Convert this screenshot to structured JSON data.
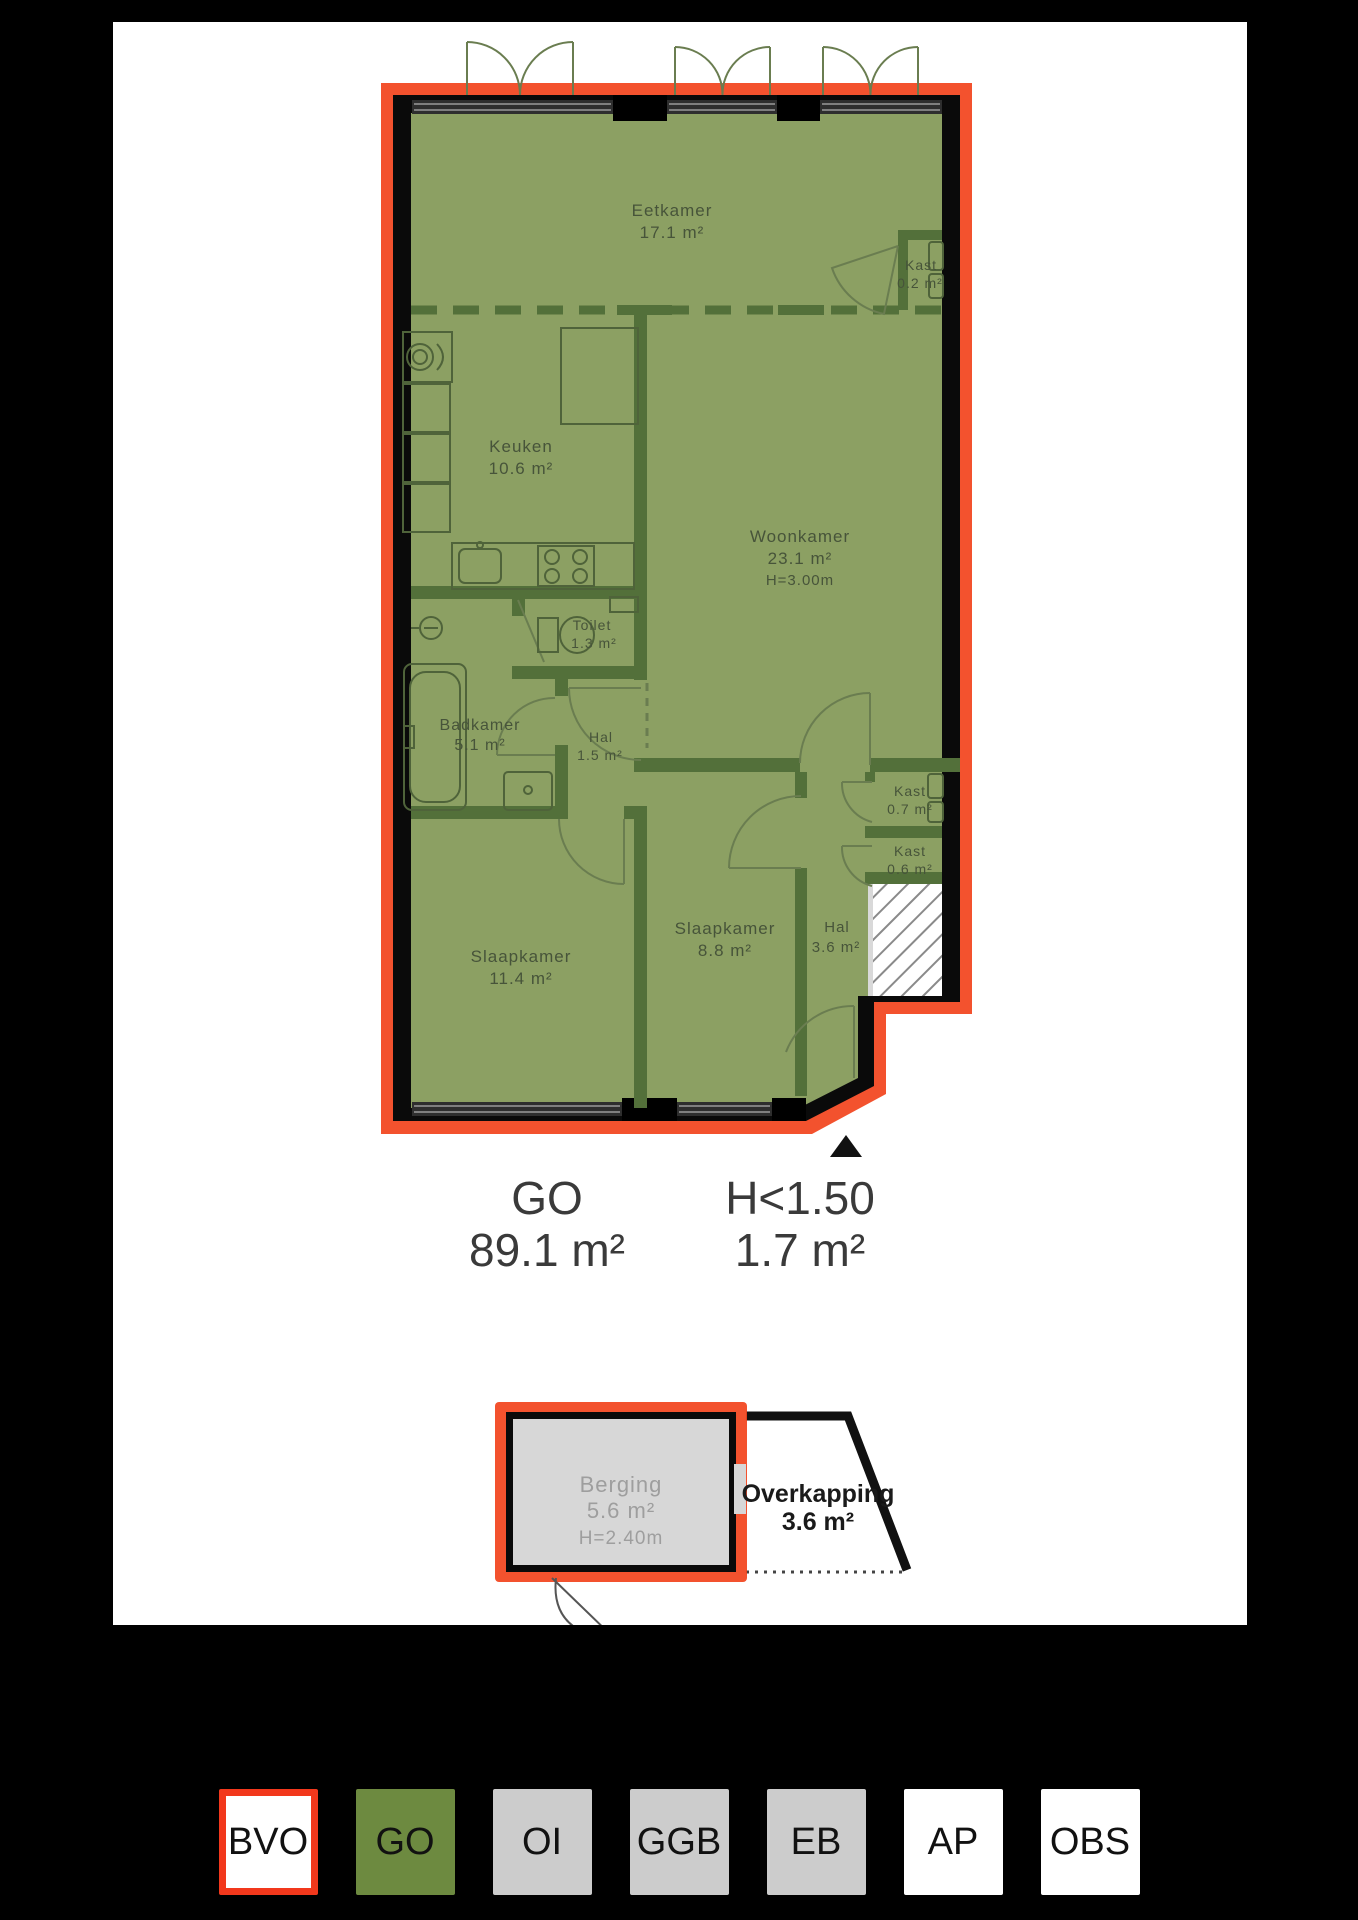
{
  "colors": {
    "outline_red": "#f2381c",
    "go_fill_green": "#8ca063",
    "go_button_green": "#6d8a40",
    "interior_wall_green": "#53703a",
    "wall_black": "#0a0a0a",
    "legend_gray": "#cccccc",
    "annex_gray_fill": "#d7d7d7"
  },
  "fp": {
    "rooms": {
      "eetkamer": {
        "name": "Eetkamer",
        "area": "17.1 m²"
      },
      "kast02": {
        "name": "Kast",
        "area": "0.2 m²"
      },
      "keuken": {
        "name": "Keuken",
        "area": "10.6 m²"
      },
      "woonkamer": {
        "name": "Woonkamer",
        "area": "23.1 m²",
        "height": "H=3.00m"
      },
      "toilet": {
        "name": "Toilet",
        "area": "1.3 m²"
      },
      "badkamer": {
        "name": "Badkamer",
        "area": "5.1 m²"
      },
      "hal1": {
        "name": "Hal",
        "area": "1.5 m²"
      },
      "kast07": {
        "name": "Kast",
        "area": "0.7 m²"
      },
      "kast06": {
        "name": "Kast",
        "area": "0.6 m²"
      },
      "slaapkamer1": {
        "name": "Slaapkamer",
        "area": "11.4 m²"
      },
      "slaapkamer2": {
        "name": "Slaapkamer",
        "area": "8.8 m²"
      },
      "hal2": {
        "name": "Hal",
        "area": "3.6 m²"
      }
    },
    "summary": {
      "go": {
        "label": "GO",
        "value": "89.1 m²"
      },
      "low": {
        "label": "H<1.50",
        "value": "1.7 m²"
      }
    },
    "annex": {
      "berging": {
        "name": "Berging",
        "area": "5.6 m²",
        "height": "H=2.40m"
      },
      "overkapping": {
        "name": "Overkapping",
        "area": "3.6 m²"
      }
    }
  },
  "legend": {
    "items": [
      {
        "label": "BVO"
      },
      {
        "label": "GO"
      },
      {
        "label": "OI"
      },
      {
        "label": "GGB"
      },
      {
        "label": "EB"
      },
      {
        "label": "AP"
      },
      {
        "label": "OBS"
      }
    ]
  }
}
